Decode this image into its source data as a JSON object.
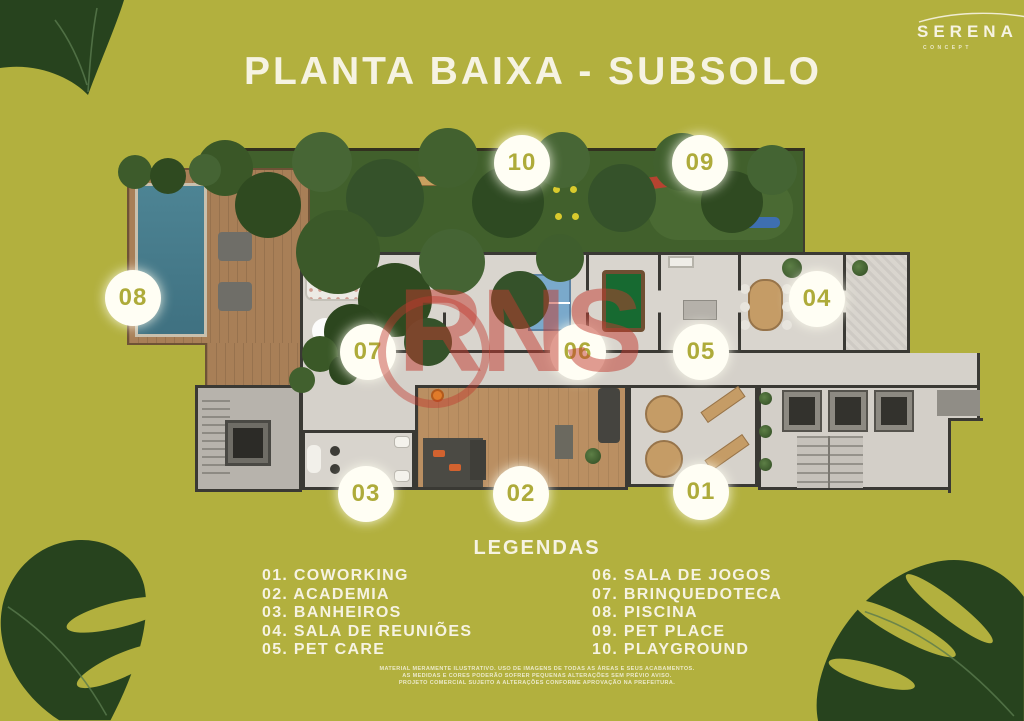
{
  "header": {
    "title": "PLANTA BAIXA - SUBSOLO"
  },
  "logo": {
    "name": "SERENA",
    "tagline": "CONCEPT"
  },
  "watermark": {
    "text": "RNS"
  },
  "floor_plan": {
    "badges": [
      {
        "num": "10",
        "x": 522,
        "y": 163
      },
      {
        "num": "09",
        "x": 700,
        "y": 163
      },
      {
        "num": "08",
        "x": 133,
        "y": 298
      },
      {
        "num": "07",
        "x": 368,
        "y": 352
      },
      {
        "num": "06",
        "x": 578,
        "y": 352
      },
      {
        "num": "05",
        "x": 701,
        "y": 352
      },
      {
        "num": "04",
        "x": 817,
        "y": 299
      },
      {
        "num": "03",
        "x": 366,
        "y": 494
      },
      {
        "num": "02",
        "x": 521,
        "y": 494
      },
      {
        "num": "01",
        "x": 701,
        "y": 492
      }
    ]
  },
  "legend": {
    "title": "LEGENDAS",
    "left": [
      "01. COWORKING",
      "02. ACADEMIA",
      "03. BANHEIROS",
      "04. SALA DE REUNIÕES",
      "05. PET CARE"
    ],
    "right": [
      "06. SALA DE JOGOS",
      "07. BRINQUEDOTECA",
      "08. PISCINA",
      "09. PET PLACE",
      "10. PLAYGROUND"
    ]
  },
  "disclaimer": [
    "MATERIAL MERAMENTE ILUSTRATIVO. USO DE IMAGENS DE TODAS AS ÁREAS E SEUS ACABAMENTOS.",
    "AS MEDIDAS E CORES PODERÃO SOFRER PEQUENAS ALTERAÇÕES SEM PRÉVIO AVISO.",
    "PROJETO COMERCIAL SUJEITO A ALTERAÇÕES CONFORME APROVAÇÃO NA PREFEITURA."
  ],
  "colors": {
    "background": "#b2b03e",
    "text_cream": "#f6f3e2",
    "badge_bg": "#fffef4",
    "badge_text": "#aeab3a",
    "watermark_red": "#c2392e",
    "leaf_dark": "#2a451f",
    "garden_green": "#41602c",
    "pool_blue": "#4a7f8f",
    "deck_wood": "#a87f57",
    "floor_gray": "#d9d5ce",
    "wall_dark": "#3a3934",
    "gym_wood": "#ba8f62"
  }
}
